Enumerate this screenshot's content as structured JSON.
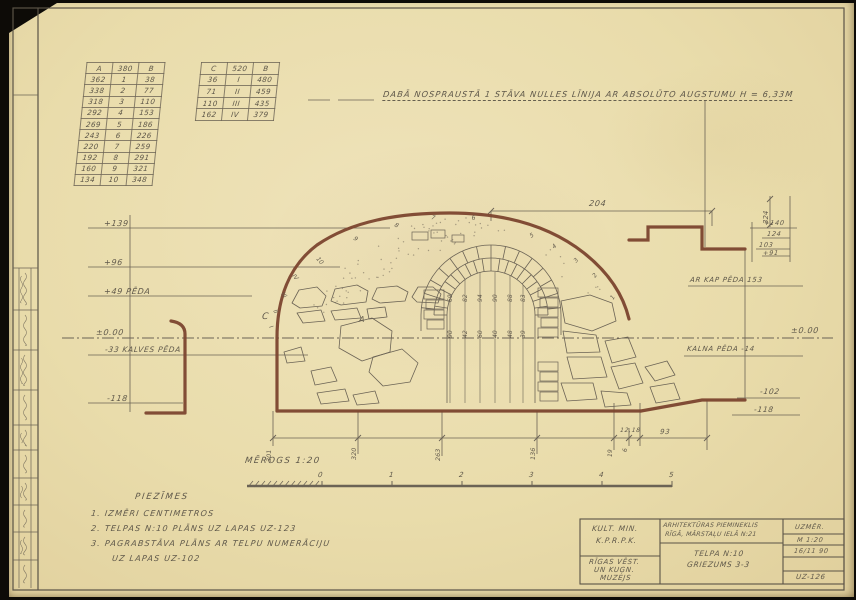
{
  "colors": {
    "paper": "#e9dcab",
    "pencil": "#645c4e",
    "brown": "#7c452f"
  },
  "heading": {
    "text": "DABĀ NOSPRAUSTĀ 1 STĀVA NULLES LĪNIJA AR ABSOLŪTO AUGSTUMU H = 6,33M"
  },
  "tables": {
    "a": {
      "header": [
        "A",
        "380",
        "B"
      ],
      "rows": [
        [
          "362",
          "1",
          "38"
        ],
        [
          "338",
          "2",
          "77"
        ],
        [
          "318",
          "3",
          "110"
        ],
        [
          "292",
          "4",
          "153"
        ],
        [
          "269",
          "5",
          "186"
        ],
        [
          "243",
          "6",
          "226"
        ],
        [
          "220",
          "7",
          "259"
        ],
        [
          "192",
          "8",
          "291"
        ],
        [
          "160",
          "9",
          "321"
        ],
        [
          "134",
          "10",
          "348"
        ]
      ]
    },
    "c": {
      "header": [
        "C",
        "520",
        "B"
      ],
      "rows": [
        [
          "36",
          "I",
          "480"
        ],
        [
          "71",
          "II",
          "459"
        ],
        [
          "110",
          "III",
          "435"
        ],
        [
          "162",
          "IV",
          "379"
        ]
      ]
    }
  },
  "levels": {
    "left": {
      "l139": "+139",
      "l96": "+96",
      "l49": "+49 PĒDA",
      "zero": "±0.00",
      "l33": "-33 KALVES PĒDA",
      "l118": "-118"
    },
    "right": {
      "l140": "+140",
      "l124": "124",
      "l103": "103",
      "l91": "+91",
      "kap": "AR KAP PĒDA 153",
      "zero": "±0.00",
      "kalna": "KALNA PĒDA -14",
      "l102": "-102",
      "l118": "-118"
    }
  },
  "marks": {
    "c": "C",
    "a": "A"
  },
  "dims": {
    "top": "204",
    "side": "324",
    "bottom_rot": [
      "301",
      "320",
      "263",
      "136",
      "19",
      "6"
    ],
    "bottom_h": [
      "12,18",
      "93"
    ],
    "arch_top": [
      "69",
      "82",
      "94",
      "90",
      "88",
      "83"
    ],
    "arch_bottom": [
      "90",
      "42",
      "60",
      "40",
      "48",
      "39"
    ]
  },
  "curve_points": {
    "arabic": [
      "1",
      "2",
      "3",
      "4",
      "5",
      "6",
      "7",
      "8",
      "9",
      "10"
    ],
    "roman": [
      "I",
      "II",
      "III",
      "IV"
    ]
  },
  "scale": {
    "label": "MĒROGS 1:20",
    "ticks": [
      "0",
      "1",
      "2",
      "3",
      "4",
      "5"
    ]
  },
  "notes": {
    "title": "PIEZĪMES",
    "line1": "1. IZMĒRI CENTIMETROS",
    "line2": "2. TELPAS N:10 PLĀNS UZ LAPAS UZ-123",
    "line3": "3. PAGRABSTĀVA PLĀNS AR TELPU NUMERĀCIJU",
    "line4": "UZ LAPAS UZ-102"
  },
  "titleblock": {
    "org_line1": "KULT. MIN.",
    "org_line2": "K.P.R.P.K.",
    "museum_line1": "RĪGAS VĒST.",
    "museum_line2": "UN KUĢN.",
    "museum_line3": "MUZEJS",
    "monument_line1": "ARHITEKTŪRAS PIEMINEKLIS",
    "monument_line2": "RĪGĀ, MĀRSTAĻU IELĀ N:21",
    "subject_line1": "TELPA N:10",
    "subject_line2": "GRIEZUMS 3-3",
    "measure": "UZMĒR.",
    "scale": "M 1:20",
    "date": "16/11 90",
    "sheet": "UZ-126"
  }
}
